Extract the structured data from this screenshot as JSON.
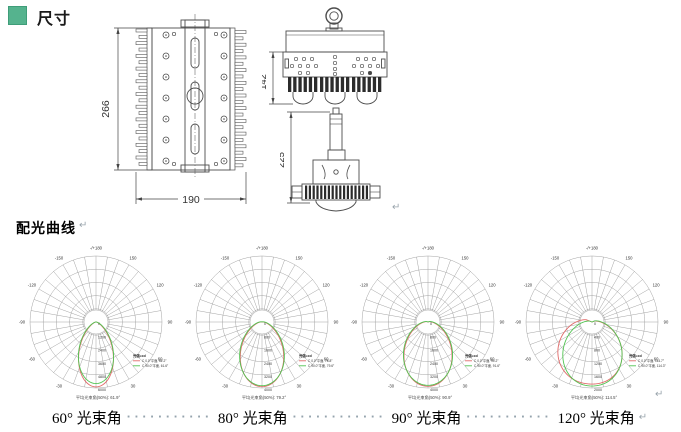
{
  "page": {
    "section_dimensions_title": "尺寸",
    "section_curves_title": "配光曲线",
    "return_mark": "↵",
    "accent_green": "#55b38e"
  },
  "dimension_drawings": {
    "back_view": {
      "height": "266",
      "width": "190"
    },
    "front_view": {
      "height": "142"
    },
    "side_view": {
      "height": "225"
    }
  },
  "chart_data": [
    {
      "type": "line",
      "coords": "polar-intensity",
      "beam_angle_label": "60° 光束角",
      "rmax": 6000,
      "radial_ticks": [
        0,
        1200,
        2400,
        3600,
        4800,
        6000
      ],
      "angle_labels": [
        {
          "a": 180,
          "t": "-/+180"
        },
        {
          "a": -150,
          "t": "-150"
        },
        {
          "a": 150,
          "t": "150"
        },
        {
          "a": -120,
          "t": "-120"
        },
        {
          "a": 120,
          "t": "120"
        },
        {
          "a": -90,
          "t": "-90"
        },
        {
          "a": 90,
          "t": "90"
        },
        {
          "a": -60,
          "t": "-60"
        },
        {
          "a": 60,
          "t": "60"
        },
        {
          "a": -30,
          "t": "-30"
        },
        {
          "a": 30,
          "t": "30"
        }
      ],
      "legend_title": "光强=cd",
      "series": [
        {
          "name": "C 0.0°平面, 62.2°",
          "color": "#e06a6a",
          "peak_cd": 5900,
          "half_angle_left": 31,
          "half_angle_right": 31,
          "profile_exp": 2
        },
        {
          "name": "C 90.0°平面, 61.6°",
          "color": "#52c452",
          "peak_cd": 5600,
          "half_angle_left": 33,
          "half_angle_right": 33,
          "profile_exp": 2
        }
      ],
      "footer": "平均光束角(50%): 61.9°"
    },
    {
      "type": "line",
      "coords": "polar-intensity",
      "beam_angle_label": "80° 光束角",
      "rmax": 4000,
      "radial_ticks": [
        0,
        800,
        1600,
        2400,
        3200,
        4000
      ],
      "angle_labels": [
        {
          "a": 180,
          "t": "-/+180"
        },
        {
          "a": -150,
          "t": "-150"
        },
        {
          "a": 150,
          "t": "150"
        },
        {
          "a": -120,
          "t": "-120"
        },
        {
          "a": 120,
          "t": "120"
        },
        {
          "a": -90,
          "t": "-90"
        },
        {
          "a": 90,
          "t": "90"
        },
        {
          "a": -60,
          "t": "-60"
        },
        {
          "a": 60,
          "t": "60"
        },
        {
          "a": -30,
          "t": "-30"
        },
        {
          "a": 30,
          "t": "30"
        }
      ],
      "legend_title": "光强=cd",
      "series": [
        {
          "name": "C 0.0°平面, 78.8°",
          "color": "#e06a6a",
          "peak_cd": 3920,
          "half_angle_left": 39.5,
          "half_angle_right": 39.5,
          "profile_exp": 2
        },
        {
          "name": "C 90.0°平面, 79.6°",
          "color": "#52c452",
          "peak_cd": 3860,
          "half_angle_left": 41.5,
          "half_angle_right": 41.5,
          "profile_exp": 2
        }
      ],
      "footer": "平均光束角(50%): 79.2°"
    },
    {
      "type": "line",
      "coords": "polar-intensity",
      "beam_angle_label": "90° 光束角",
      "rmax": 4000,
      "radial_ticks": [
        0,
        800,
        1600,
        2400,
        3200,
        4000
      ],
      "angle_labels": [
        {
          "a": 180,
          "t": "-/+180"
        },
        {
          "a": -150,
          "t": "-150"
        },
        {
          "a": 150,
          "t": "150"
        },
        {
          "a": -120,
          "t": "-120"
        },
        {
          "a": 120,
          "t": "120"
        },
        {
          "a": -90,
          "t": "-90"
        },
        {
          "a": 90,
          "t": "90"
        },
        {
          "a": -60,
          "t": "-60"
        },
        {
          "a": 60,
          "t": "60"
        },
        {
          "a": -30,
          "t": "-30"
        },
        {
          "a": 30,
          "t": "30"
        }
      ],
      "legend_title": "光强=cd",
      "series": [
        {
          "name": "C 0.0°平面, 90.2°",
          "color": "#e06a6a",
          "peak_cd": 3900,
          "half_angle_left": 44.5,
          "half_angle_right": 44.5,
          "profile_exp": 2
        },
        {
          "name": "C 90.0°平面, 91.6°",
          "color": "#52c452",
          "peak_cd": 3840,
          "half_angle_left": 46.5,
          "half_angle_right": 46.5,
          "profile_exp": 2
        }
      ],
      "footer": "平均光束角(50%): 90.9°"
    },
    {
      "type": "line",
      "coords": "polar-intensity",
      "beam_angle_label": "120° 光束角",
      "rmax": 2000,
      "radial_ticks": [
        0,
        400,
        800,
        1200,
        1600,
        2000
      ],
      "angle_labels": [
        {
          "a": 180,
          "t": "-/+180"
        },
        {
          "a": -150,
          "t": "-150"
        },
        {
          "a": 150,
          "t": "150"
        },
        {
          "a": -120,
          "t": "-120"
        },
        {
          "a": 120,
          "t": "120"
        },
        {
          "a": -90,
          "t": "-90"
        },
        {
          "a": 90,
          "t": "90"
        },
        {
          "a": -60,
          "t": "-60"
        },
        {
          "a": 60,
          "t": "60"
        },
        {
          "a": -30,
          "t": "-30"
        },
        {
          "a": 30,
          "t": "30"
        }
      ],
      "legend_title": "光强=cd",
      "series": [
        {
          "name": "C 0.0°平面, 114.7°",
          "color": "#e06a6a",
          "peak_cd": 1880,
          "half_angle_left": 68,
          "half_angle_right": 58,
          "profile_exp": 2.4
        },
        {
          "name": "C 90.0°平面, 114.3°",
          "color": "#52c452",
          "peak_cd": 1940,
          "half_angle_left": 55,
          "half_angle_right": 57,
          "profile_exp": 2.2
        }
      ],
      "footer": "平均光束角(50%): 114.5°"
    }
  ],
  "beam_captions": {
    "items": [
      {
        "label": "60° 光束角"
      },
      {
        "label": "80° 光束角"
      },
      {
        "label": "90° 光束角"
      },
      {
        "label": "120° 光束角"
      }
    ],
    "separators": [
      "···········",
      "············",
      "···········"
    ]
  }
}
